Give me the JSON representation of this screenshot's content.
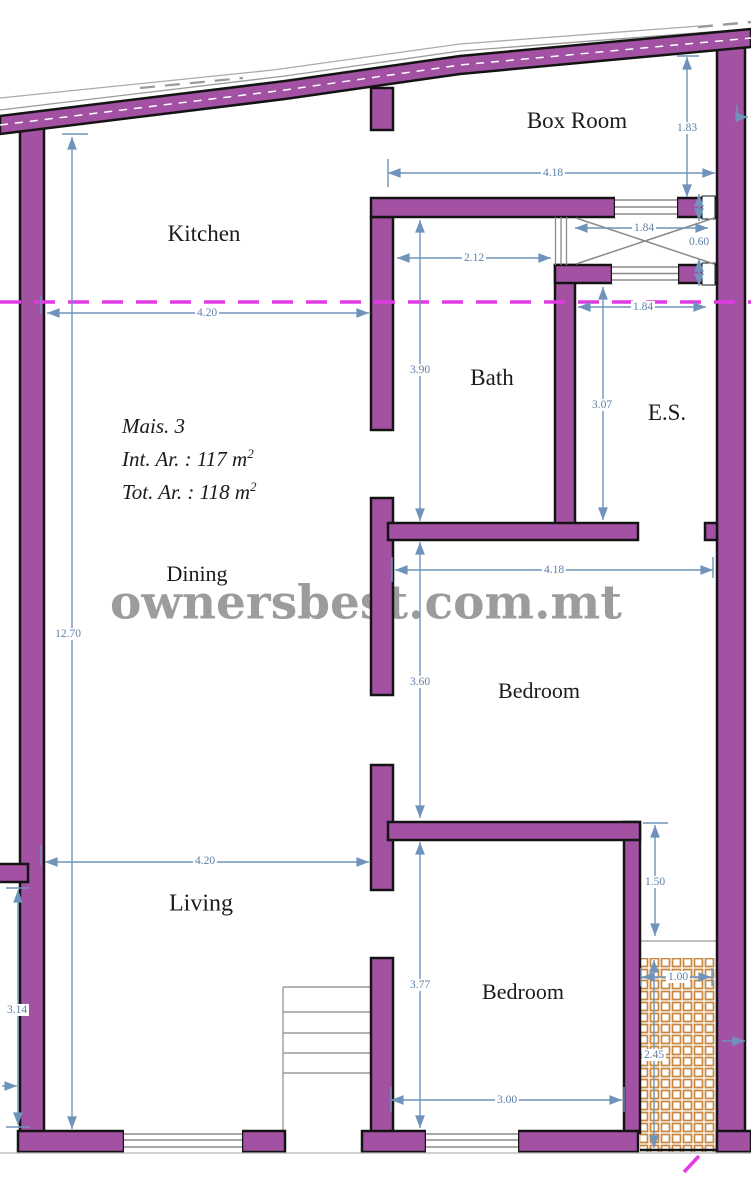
{
  "watermark": {
    "text": "ownersbest.com.mt"
  },
  "area_note": {
    "title": "Mais. 3",
    "int_label": "Int. Ar. : 117 m",
    "int_sup": "2",
    "tot_label": "Tot. Ar. : 118 m",
    "tot_sup": "2"
  },
  "rooms": {
    "box_room": "Box Room",
    "kitchen": "Kitchen",
    "bath": "Bath",
    "es": "E.S.",
    "dining": "Dining",
    "bedroom_top": "Bedroom",
    "living": "Living",
    "bedroom_bottom": "Bedroom"
  },
  "dimensions": {
    "box_room_height": "1.83",
    "box_room_width": "4.18",
    "shaft_width_top": "1.84",
    "shaft_depth": "0.60",
    "bath_top_width": "2.12",
    "shaft_width_bottom": "1.84",
    "kitchen_width": "4.20",
    "bath_height": "3.90",
    "es_height": "3.07",
    "plan_height": "12.70",
    "bedroom_top_width": "4.18",
    "bedroom_top_height": "3.60",
    "yard_offset": "1.50",
    "yard_width": "1.00",
    "living_width": "4.20",
    "bedroom_bottom_height": "3.77",
    "living_height": "3.14",
    "bedroom_bottom_width": "3.00",
    "yard_height": "2.45"
  },
  "colors": {
    "wall_fill": "#A351A3",
    "wall_outline": "#141414",
    "dimension_line": "#6f93bb",
    "dimension_text": "#5d7fa6",
    "section_line": "#E23AE2",
    "yard_hatch": "#C9863E",
    "boundary_line": "#9a9a9a",
    "watermark_text": "#9c9c9c"
  }
}
